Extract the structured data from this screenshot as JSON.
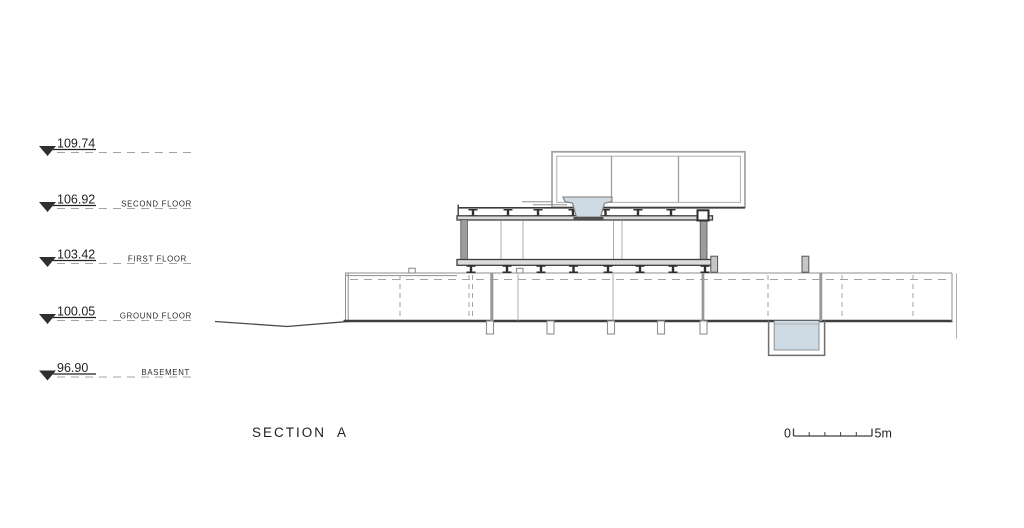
{
  "title": {
    "text": "SECTION A"
  },
  "levels": [
    {
      "elevation": "109.74",
      "label": ""
    },
    {
      "elevation": "106.92",
      "label": "SECOND FLOOR"
    },
    {
      "elevation": "103.42",
      "label": "FIRST FLOOR"
    },
    {
      "elevation": "100.05",
      "label": "GROUND FLOOR"
    },
    {
      "elevation": "96.90",
      "label": "BASEMENT"
    }
  ],
  "scale_bar": {
    "zero_label": "0",
    "end_label": "5m"
  },
  "colors": {
    "text": "#1f1f1f",
    "line-dark": "#3e3e3e",
    "line-gray": "#8f8f8f",
    "line-light": "#aeaeae",
    "line-dash": "#a3a3a3",
    "wall-gray": "#9c9c9c",
    "water": "#cedbe4",
    "background": "#ffffff"
  }
}
